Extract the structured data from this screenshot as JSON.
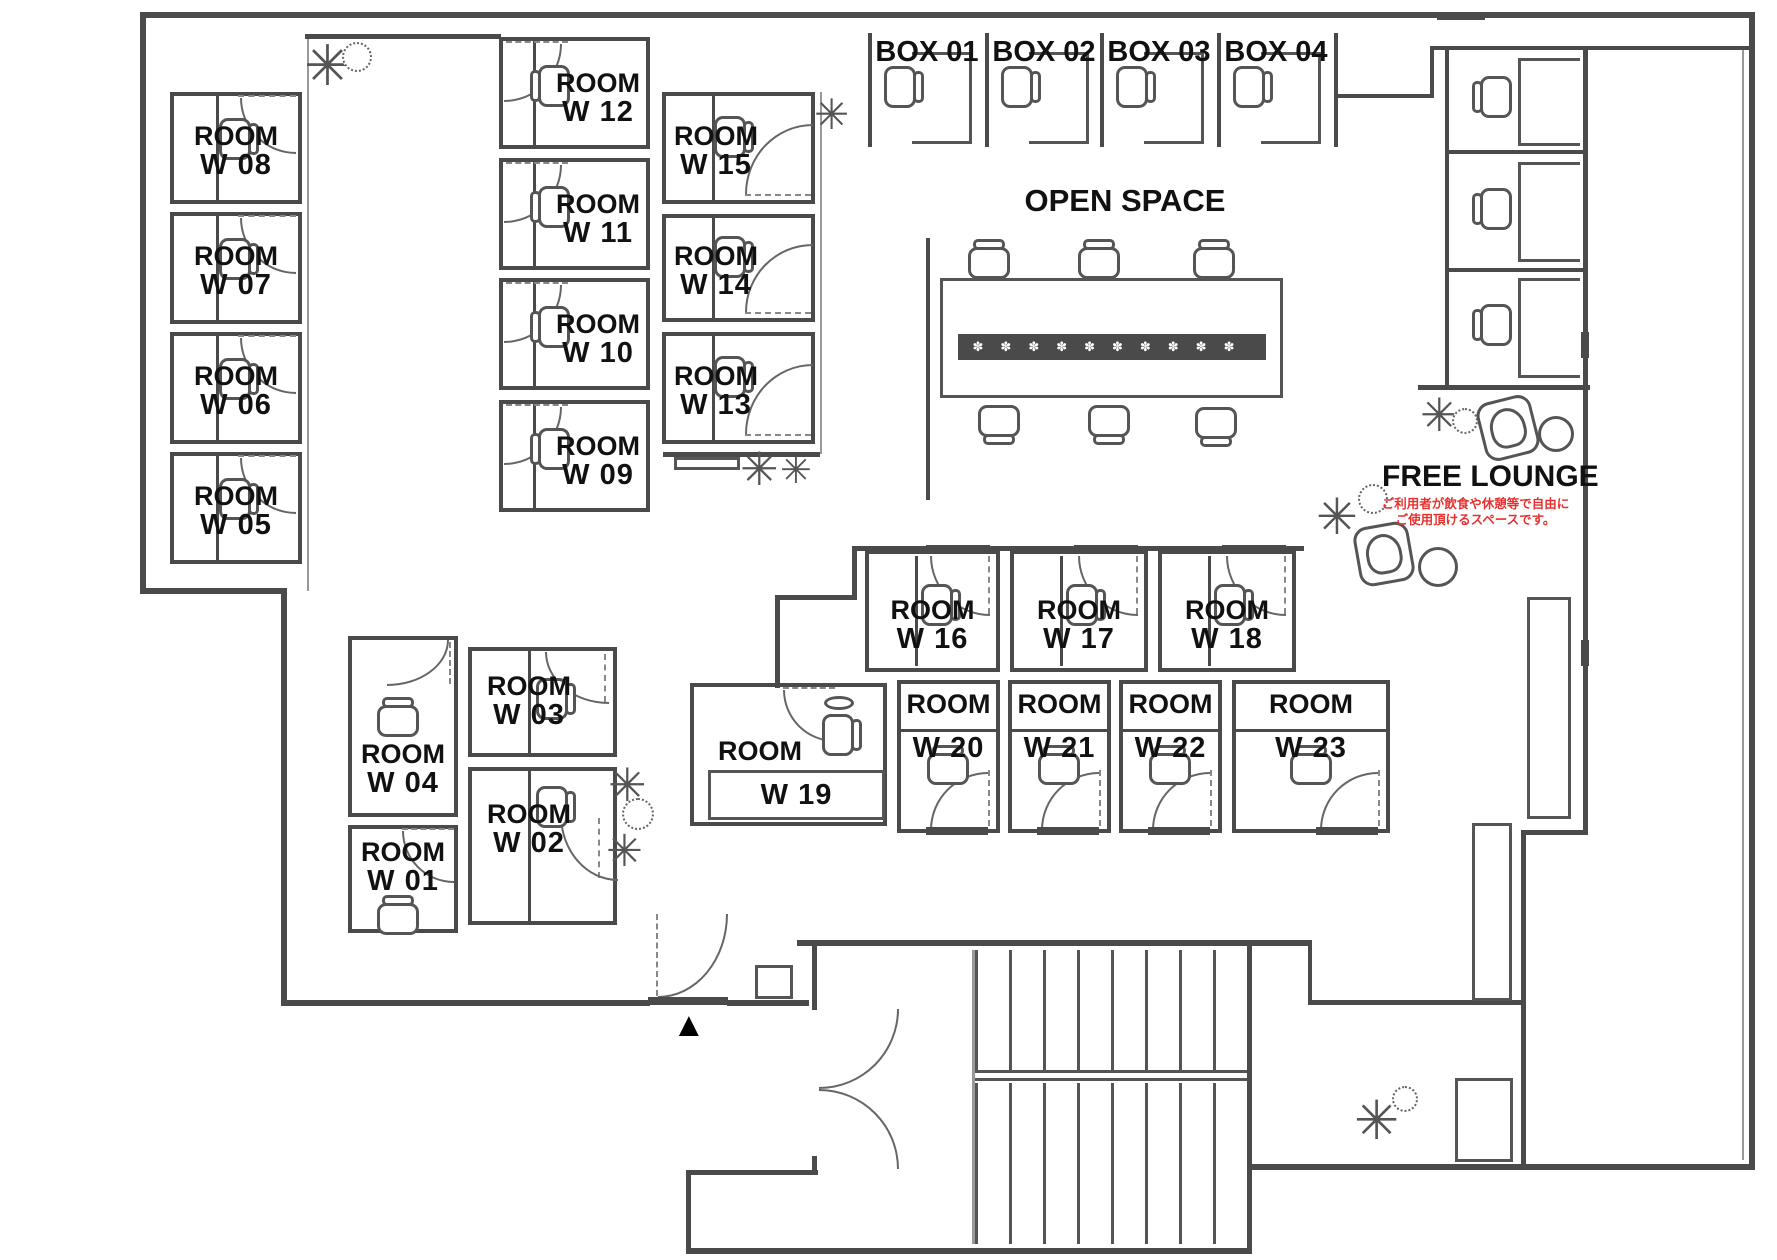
{
  "plan": {
    "areas": {
      "open_space": "OPEN SPACE",
      "free_lounge": "FREE LOUNGE"
    },
    "free_lounge_note": {
      "line1": "ご利用者が飲食や休憩等で自由に",
      "line2": "ご使用頂けるスペースです。"
    },
    "rooms": {
      "w01": {
        "l1": "ROOM",
        "l2": "W 01"
      },
      "w02": {
        "l1": "ROOM",
        "l2": "W 02"
      },
      "w03": {
        "l1": "ROOM",
        "l2": "W 03"
      },
      "w04": {
        "l1": "ROOM",
        "l2": "W 04"
      },
      "w05": {
        "l1": "ROOM",
        "l2": "W 05"
      },
      "w06": {
        "l1": "ROOM",
        "l2": "W 06"
      },
      "w07": {
        "l1": "ROOM",
        "l2": "W 07"
      },
      "w08": {
        "l1": "ROOM",
        "l2": "W 08"
      },
      "w09": {
        "l1": "ROOM",
        "l2": "W 09"
      },
      "w10": {
        "l1": "ROOM",
        "l2": "W 10"
      },
      "w11": {
        "l1": "ROOM",
        "l2": "W 11"
      },
      "w12": {
        "l1": "ROOM",
        "l2": "W 12"
      },
      "w13": {
        "l1": "ROOM",
        "l2": "W 13"
      },
      "w14": {
        "l1": "ROOM",
        "l2": "W 14"
      },
      "w15": {
        "l1": "ROOM",
        "l2": "W 15"
      },
      "w16": {
        "l1": "ROOM",
        "l2": "W 16"
      },
      "w17": {
        "l1": "ROOM",
        "l2": "W 17"
      },
      "w18": {
        "l1": "ROOM",
        "l2": "W 18"
      },
      "w19": {
        "l1": "ROOM",
        "l2": "W 19"
      },
      "w20": {
        "l1": "ROOM",
        "l2": "W 20"
      },
      "w21": {
        "l1": "ROOM",
        "l2": "W 21"
      },
      "w22": {
        "l1": "ROOM",
        "l2": "W 22"
      },
      "w23": {
        "l1": "ROOM",
        "l2": "W 23"
      }
    },
    "boxes": {
      "b01": {
        "label": "BOX 01"
      },
      "b02": {
        "label": "BOX 02"
      },
      "b03": {
        "label": "BOX 03"
      },
      "b04": {
        "label": "BOX 04"
      }
    },
    "icons": {
      "plant": "✳",
      "entrance_triangle": "▲",
      "table_flowers": "✽✽✽✽✽✽✽✽✽✽"
    },
    "colors": {
      "wall": "#4a4a4a",
      "text": "#111111",
      "note_red": "#e8312e"
    }
  }
}
